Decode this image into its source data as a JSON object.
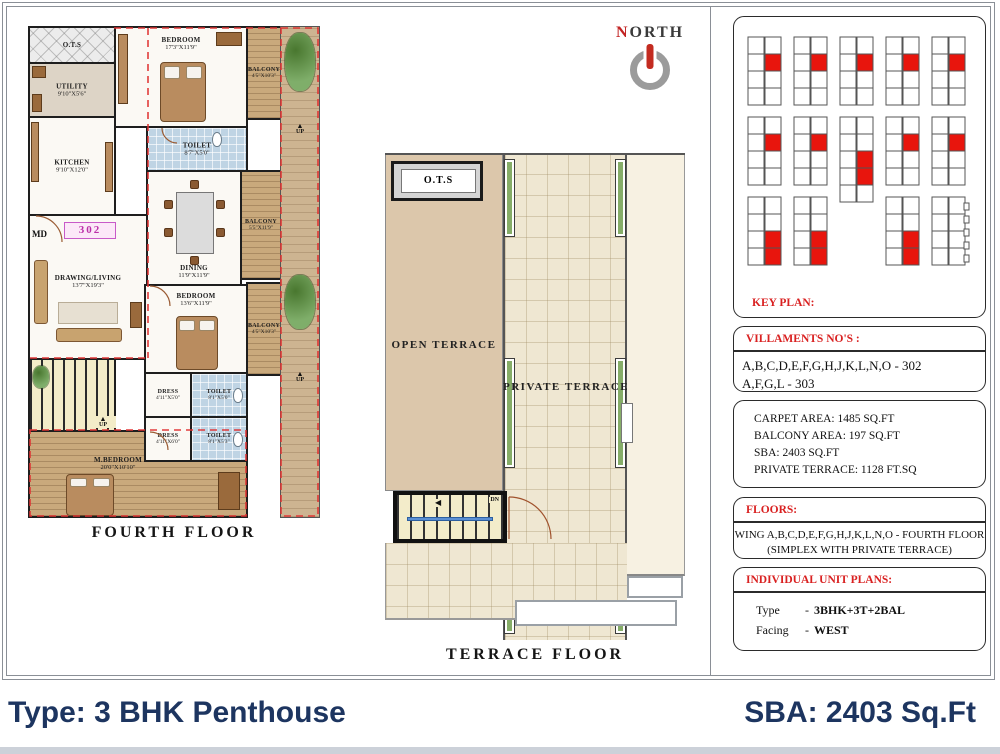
{
  "title_bar": {
    "left": "Type: 3 BHK Penthouse",
    "right": "SBA: 2403 Sq.Ft"
  },
  "north": {
    "n": "N",
    "orth": "ORTH"
  },
  "icons": {
    "up_arrow": "▲",
    "dn_arrow": "◀"
  },
  "fourth_floor": {
    "caption": "FOURTH  FLOOR",
    "unit_no": "302",
    "md": "MD",
    "up": "UP",
    "rooms": {
      "ots": {
        "name": "O.T.S",
        "dims": ""
      },
      "utility": {
        "name": "UTILITY",
        "dims": "9'10\"X5'6\""
      },
      "kitchen": {
        "name": "KITCHEN",
        "dims": "9'10\"X12'0\""
      },
      "living": {
        "name": "DRAWING/LIVING",
        "dims": "13'7\"X19'3\""
      },
      "dining": {
        "name": "DINING",
        "dims": "11'9\"X11'9\""
      },
      "bedroom1": {
        "name": "BEDROOM",
        "dims": "17'3\"X11'9\""
      },
      "bedroom2": {
        "name": "BEDROOM",
        "dims": "13'6\"X11'9\""
      },
      "mbedroom": {
        "name": "M.BEDROOM",
        "dims": "20'0\"X10'10\""
      },
      "toilet1": {
        "name": "TOILET",
        "dims": "8'7\"X5'0\""
      },
      "toilet2": {
        "name": "TOILET",
        "dims": "8'1\"X5'0\""
      },
      "toilet3": {
        "name": "TOILET",
        "dims": "8'1\"X5'3\""
      },
      "dress1": {
        "name": "DRESS",
        "dims": "4'11\"X5'0\""
      },
      "dress2": {
        "name": "DRESS",
        "dims": "4'11\"X6'0\""
      },
      "balcony1": {
        "name": "BALCONY",
        "dims": "4'5\"X10'3\""
      },
      "balcony2": {
        "name": "BALCONY",
        "dims": "5'5\"X11'9\""
      },
      "balcony3": {
        "name": "BALCONY",
        "dims": "4'5\"X10'3\""
      }
    }
  },
  "terrace_floor": {
    "caption": "TERRACE  FLOOR",
    "ots": "O.T.S",
    "open_terrace": "OPEN TERRACE",
    "private_terrace": "PRIVATE TERRACE",
    "dn": "DN"
  },
  "side_panel": {
    "key_plan": {
      "label": "KEY PLAN:",
      "wings": [
        {
          "x": 14,
          "y": 14,
          "rows": 4,
          "red": [
            1
          ]
        },
        {
          "x": 60,
          "y": 14,
          "rows": 4,
          "red": [
            1
          ]
        },
        {
          "x": 106,
          "y": 14,
          "rows": 4,
          "red": [
            1
          ]
        },
        {
          "x": 152,
          "y": 14,
          "rows": 4,
          "red": [
            1
          ]
        },
        {
          "x": 198,
          "y": 14,
          "rows": 4,
          "red": [
            1
          ]
        },
        {
          "x": 14,
          "y": 94,
          "rows": 4,
          "red": [
            1
          ]
        },
        {
          "x": 60,
          "y": 94,
          "rows": 4,
          "red": [
            1
          ]
        },
        {
          "x": 106,
          "y": 94,
          "rows": 5,
          "red": [
            2,
            3
          ]
        },
        {
          "x": 152,
          "y": 94,
          "rows": 4,
          "red": [
            1
          ]
        },
        {
          "x": 198,
          "y": 94,
          "rows": 4,
          "red": [
            1
          ]
        },
        {
          "x": 14,
          "y": 174,
          "rows": 4,
          "red": [
            2,
            3
          ]
        },
        {
          "x": 60,
          "y": 174,
          "rows": 4,
          "red": [
            2,
            3
          ]
        },
        {
          "x": 152,
          "y": 174,
          "rows": 4,
          "red": [
            2,
            3
          ]
        },
        {
          "x": 198,
          "y": 174,
          "rows": 4,
          "red": [],
          "notched": true
        }
      ]
    },
    "villaments": {
      "header": "VILLAMENTS NO'S :",
      "lines": [
        "A,B,C,D,E,F,G,H,J,K,L,N,O - 302",
        "A,F,G,L - 303"
      ]
    },
    "areas": {
      "lines": [
        "CARPET AREA: 1485 SQ.FT",
        "BALCONY AREA: 197 SQ.FT",
        "SBA: 2403 SQ.FT",
        "PRIVATE TERRACE: 1128 FT.SQ"
      ]
    },
    "floors": {
      "header": "FLOORS:",
      "lines": [
        "WING A,B,C,D,E,F,G,H,J,K,L,N,O  - FOURTH FLOOR",
        "(SIMPLEX WITH  PRIVATE TERRACE)"
      ]
    },
    "unit_plans": {
      "header": "INDIVIDUAL UNIT PLANS:",
      "rows": [
        {
          "label": "Type",
          "sep": "-",
          "value": "3BHK+3T+2BAL"
        },
        {
          "label": "Facing",
          "sep": "-",
          "value": "WEST"
        }
      ]
    }
  },
  "colors": {
    "accent_red": "#d92121",
    "unit_red": "#e8150d",
    "navy": "#1d3560",
    "balcony_tan": "#c9a97c",
    "toilet_blue": "#bfd4e4",
    "terrace_tan": "#dcc7ab",
    "terrace_tile": "#efe7d2",
    "planter_green": "#86ad68",
    "unit_pink": "#c85ac8"
  }
}
